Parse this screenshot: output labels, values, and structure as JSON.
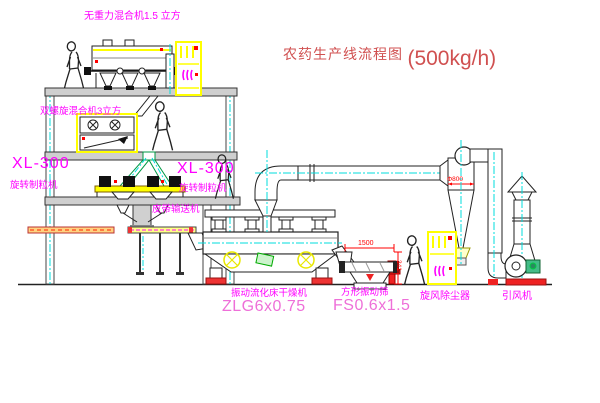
{
  "title": {
    "cn": "农药生产线流程图",
    "rate": "(500kg/h)"
  },
  "labels": {
    "mixer1": "无重力混合机1.5 立方",
    "mixer2": "双螺旋混合机3立方",
    "granulator_left": {
      "model": "XL-300",
      "name": "旋转制粒机"
    },
    "granulator_right": {
      "model": "XL-300",
      "name": "旋转制粒机"
    },
    "belt_conveyor": "皮带输送机",
    "dryer": {
      "name": "振动流化床干燥机",
      "model": "ZLG6x0.75"
    },
    "sieve": {
      "name": "方形振动筛",
      "model": "FS0.6x1.5"
    },
    "cyclone": "旋风除尘器",
    "fan": "引风机"
  },
  "dimensions": {
    "cyclone_width": "Φ800",
    "sieve_length": "1500",
    "sieve_height": "341"
  },
  "colors": {
    "label_magenta": "#ff00ff",
    "model_pink": "#ee6fd8",
    "title_red": "#d05050",
    "machine_yellow": "#ffff00",
    "centerline_cyan": "#00dede",
    "dimension_red": "#ff0000",
    "line_black": "#222222"
  }
}
